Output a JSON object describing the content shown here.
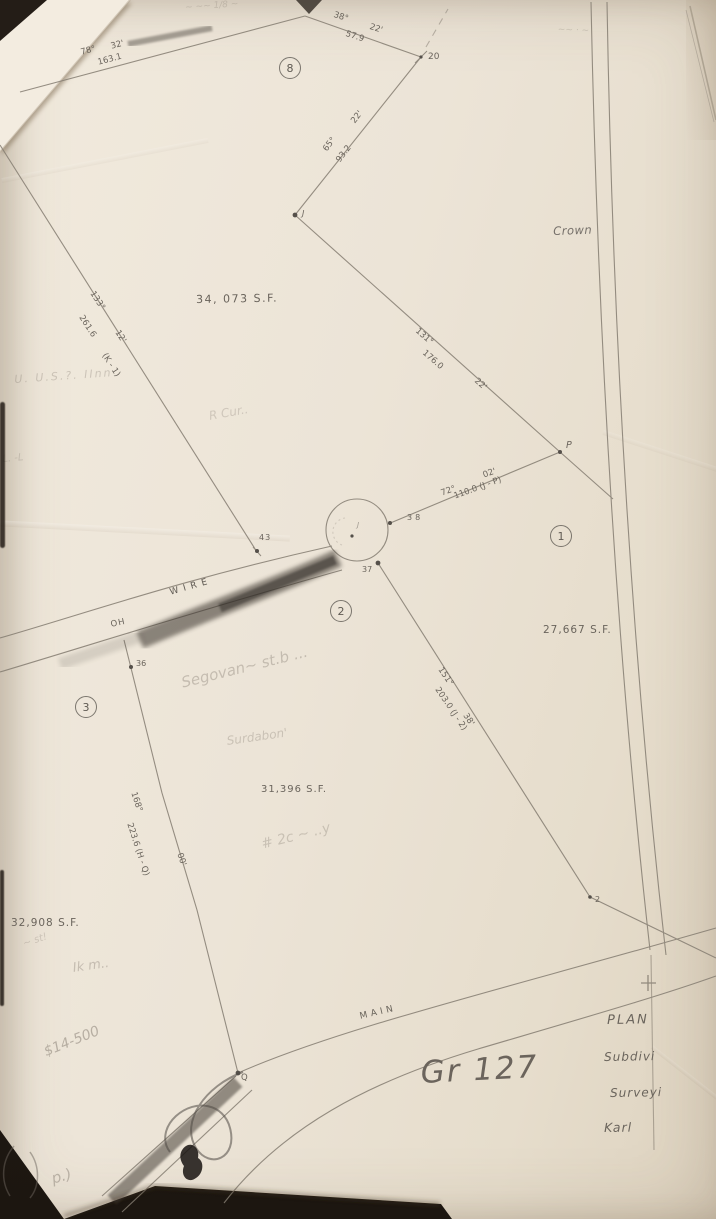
{
  "plan": {
    "lots": [
      {
        "id": "8",
        "area": "34, 073 S.F."
      },
      {
        "id": "1",
        "area": "27,667 S.F."
      },
      {
        "id": "2",
        "area": "31,396 S.F."
      },
      {
        "id": "3",
        "area": "32,908 S.F."
      }
    ],
    "bearings": {
      "b78": {
        "angle": "78°",
        "minutes": "32'",
        "distance": "163.1"
      },
      "b38": {
        "angle": "38°",
        "minutes": "22'",
        "distance": "57.9"
      },
      "b65": {
        "angle": "65°",
        "minutes": "22'",
        "distance": "93.2"
      },
      "b131": {
        "angle": "131°",
        "minutes": "22'",
        "distance": "176.0"
      },
      "b72": {
        "angle": "72°",
        "minutes": "02'",
        "distance": "110.0 (J - P)"
      },
      "b151": {
        "angle": "151°",
        "minutes": "38'",
        "distance": "203.0 (J - 2)"
      },
      "b168": {
        "angle": "168°",
        "minutes": "00'",
        "distance": "223.6 (H - Q)"
      },
      "b133": {
        "angle": "133°",
        "minutes": "12'",
        "distance": "261.6",
        "segment": "(K - 1)"
      }
    },
    "points": {
      "p20": "20",
      "pJ": "J",
      "pJc": "J",
      "pP": "P",
      "p38": "38",
      "p37": "37",
      "p43": "43",
      "p36": "36",
      "p2": "2",
      "pQ": "Q"
    },
    "roads": {
      "wire": "WIRE",
      "main": "MAIN",
      "oh": "OH"
    },
    "adjacent": {
      "crown": "Crown"
    },
    "title_block": {
      "l1": "PLAN",
      "l2": "Subdivi",
      "l3": "Surveyi",
      "l4": "Karl"
    }
  },
  "handwriting": {
    "gr_number": "Gr 127",
    "price": "$14-500",
    "segovan": "Segovan~ st.b ...",
    "surdabon": "Surdabon'",
    "hash_note": "# 2c ~ ..y",
    "us_inn": "U. U.S.?. IInn",
    "r_cur": "R Cur..",
    "l_marks": "L. -L",
    "st_note": "~ st!",
    "ik_note": "Ik m..",
    "corner": "p.)",
    "scrawl_top_left": "~ ~~ 1/8 ~",
    "scrawl_top_right": "~~ · ~"
  }
}
